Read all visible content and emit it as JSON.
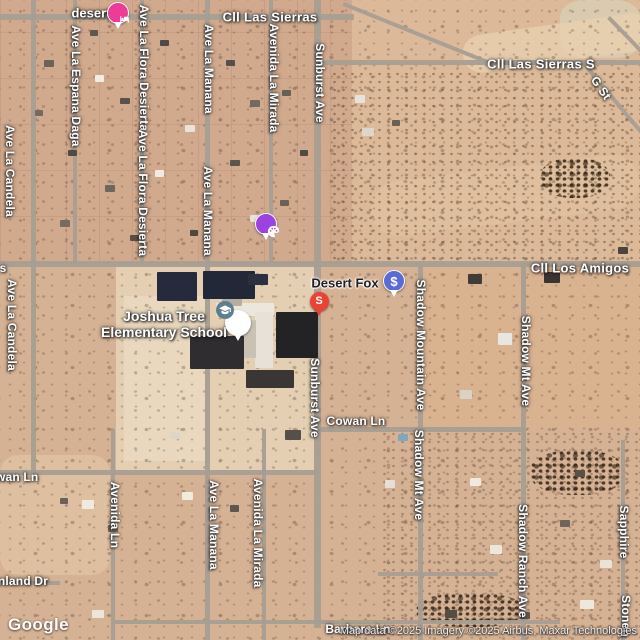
{
  "map": {
    "attribution": {
      "logo": "Google",
      "credits": "Map data ©2025 Imagery ©2025 Airbus, Maxar Technologies"
    },
    "colors": {
      "lodging_pink": "#ED3B97",
      "art_purple": "#9C42E0",
      "price_blue": "#5A6BD8",
      "pin_red": "#EA4335",
      "school_slate": "#5E7F90"
    },
    "street_labels": [
      {
        "text": "Cll Las Sierras",
        "x": 270,
        "y": 17,
        "o": "h",
        "big": true
      },
      {
        "text": "Cll Las Sierras S",
        "x": 541,
        "y": 64,
        "o": "h",
        "big": true
      },
      {
        "text": "G St",
        "x": 601,
        "y": 88,
        "o": "d",
        "angle": 55
      },
      {
        "text": "Cll Los Amigos",
        "x": 580,
        "y": 268,
        "o": "h",
        "big": true
      },
      {
        "text": "Sunburst Ave",
        "x": 320,
        "y": 83,
        "o": "v"
      },
      {
        "text": "Sunburst Ave",
        "x": 315,
        "y": 398,
        "o": "v"
      },
      {
        "text": "Ave La Espana Daga",
        "x": 76,
        "y": 86,
        "o": "v"
      },
      {
        "text": "Ave La Flora Desierta",
        "x": 144,
        "y": 68,
        "o": "v"
      },
      {
        "text": "Ave La Flora Desierta",
        "x": 143,
        "y": 193,
        "o": "v"
      },
      {
        "text": "Ave La Manana",
        "x": 209,
        "y": 69,
        "o": "v"
      },
      {
        "text": "Ave La Manana",
        "x": 208,
        "y": 211,
        "o": "v"
      },
      {
        "text": "Avenida La Mirada",
        "x": 274,
        "y": 78,
        "o": "v"
      },
      {
        "text": "Ave La Candela",
        "x": 10,
        "y": 171,
        "o": "v"
      },
      {
        "text": "Ave La Candela",
        "x": 12,
        "y": 325,
        "o": "v"
      },
      {
        "text": "Shadow Mountain Ave",
        "x": 421,
        "y": 345,
        "o": "v"
      },
      {
        "text": "Shadow Mt Ave",
        "x": 526,
        "y": 361,
        "o": "v"
      },
      {
        "text": "Shadow Mt Ave",
        "x": 419,
        "y": 475,
        "o": "v"
      },
      {
        "text": "Shadow Ranch Ave",
        "x": 523,
        "y": 561,
        "o": "v"
      },
      {
        "text": "Cowan Ln",
        "x": 356,
        "y": 421,
        "o": "h"
      },
      {
        "text": "Cowan Ln",
        "x": 9,
        "y": 477,
        "o": "h"
      },
      {
        "text": "Avenida Ln",
        "x": 115,
        "y": 515,
        "o": "v"
      },
      {
        "text": "Ave La Manana",
        "x": 214,
        "y": 525,
        "o": "v"
      },
      {
        "text": "Avenida La Mirada",
        "x": 258,
        "y": 533,
        "o": "v"
      },
      {
        "text": "nland Dr",
        "x": 23,
        "y": 581,
        "o": "h"
      },
      {
        "text": "Barbara Ln",
        "x": 358,
        "y": 629,
        "o": "h"
      },
      {
        "text": "Sapphire",
        "x": 624,
        "y": 532,
        "o": "v"
      },
      {
        "text": "Stoneh",
        "x": 626,
        "y": 616,
        "o": "v"
      },
      {
        "text": "s",
        "x": 3,
        "y": 268,
        "o": "h"
      }
    ],
    "pois": [
      {
        "id": "lodging-desert",
        "label": {
          "text": "desert",
          "x": 91,
          "y": 13,
          "style": "light",
          "big": false
        },
        "marker": {
          "x": 118,
          "y": 13,
          "shape": "balloon",
          "colorKey": "lodging_pink",
          "icon": "bed-icon"
        }
      },
      {
        "id": "art-gallery",
        "marker": {
          "x": 266,
          "y": 224,
          "shape": "balloon",
          "colorKey": "art_purple",
          "icon": "palette-icon"
        }
      },
      {
        "id": "joshua-tree-elementary-school",
        "label": {
          "lines": [
            "Joshua Tree",
            "Elementary School"
          ],
          "x": 164,
          "y": 324,
          "style": "light",
          "big": true
        },
        "marker": {
          "x": 238,
          "y": 323,
          "shape": "balloon-white",
          "colorKey": "school_slate",
          "icon": "graduation-cap-icon"
        }
      },
      {
        "id": "desert-fox",
        "label": {
          "text": "Desert Fox",
          "x": 345,
          "y": 283,
          "style": "dark",
          "big": false
        },
        "marker": {
          "x": 394,
          "y": 281,
          "shape": "balloon",
          "colorKey": "price_blue",
          "glyph": "$"
        }
      },
      {
        "id": "result-pin",
        "marker": {
          "x": 319,
          "y": 301,
          "shape": "pin",
          "colorKey": "pin_red",
          "glyph": "S"
        }
      }
    ]
  }
}
